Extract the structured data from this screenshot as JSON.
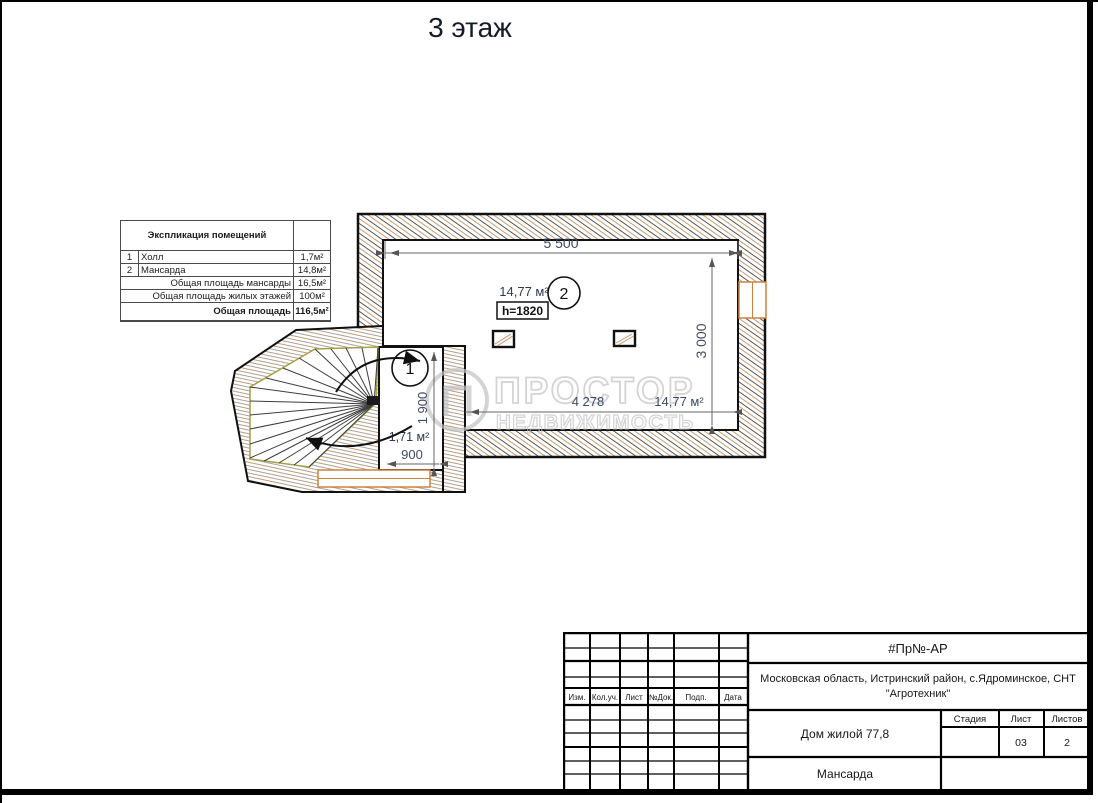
{
  "page": {
    "title": "3 этаж"
  },
  "explication_table": {
    "header": "Экспликация помещений",
    "rows": [
      {
        "num": "1",
        "name": "Холл",
        "area": "1,7м²"
      },
      {
        "num": "2",
        "name": "Мансарда",
        "area": "14,8м²"
      }
    ],
    "totals": [
      {
        "label": "Общая площадь мансарды",
        "value": "16,5м²"
      },
      {
        "label": "Общая площадь жилых этажей",
        "value": "100м²"
      },
      {
        "label": "Общая площадь",
        "value": "116,5м²"
      }
    ]
  },
  "plan": {
    "dims": {
      "top": "5 500",
      "right": "3 000",
      "inner": "4 278",
      "inner_area": "14,77 м²",
      "room1_width": "900",
      "room1_height": "1 900"
    },
    "room1": {
      "number": "1",
      "area": "1,71 м²"
    },
    "room2": {
      "number": "2",
      "area": "14,77 м²",
      "height_note": "h=1820"
    }
  },
  "watermark": {
    "line1": "ПРОСТОР",
    "line2": "НЕДВИЖИМОСТЬ",
    "logo_letter": "П"
  },
  "title_block": {
    "doc_code": "#Пр№-АР",
    "address_line1": "Московская область, Истринский район, с.Ядроминское, СНТ",
    "address_line2": "\"Агротехник\"",
    "object_name": "Дом жилой 77,8",
    "sheet_name": "Мансарда",
    "col_izm": "Изм.",
    "col_koluch": "Кол.уч.",
    "col_list": "Лист",
    "col_ndok": "№Док.",
    "col_podp": "Подп.",
    "col_data": "Дата",
    "stage_label": "Стадия",
    "sheet_label": "Лист",
    "sheets_label": "Листов",
    "sheet_value": "03",
    "sheets_value": "2"
  },
  "colors": {
    "wall_line": "#4f4f4f",
    "wall_tint": "#cf9a6b",
    "window": "#d0813b",
    "dim_text": "#3d4a63",
    "stair_outline": "#a3a044",
    "watermark": "#c3c3c3"
  }
}
